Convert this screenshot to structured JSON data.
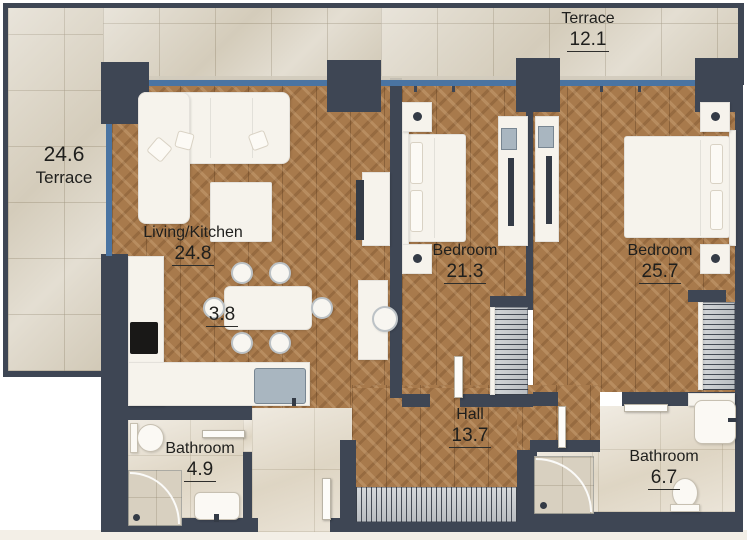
{
  "title": "Apartment floor plan",
  "rooms": [
    {
      "id": "terrace-left",
      "name": "Terrace",
      "area": "24.6"
    },
    {
      "id": "terrace-top",
      "name": "Terrace",
      "area": "12.1"
    },
    {
      "id": "living-kitchen",
      "name": "Living/Kitchen",
      "area": "24.8"
    },
    {
      "id": "kitchen-zone",
      "name": "",
      "area": "3.8"
    },
    {
      "id": "bedroom-1",
      "name": "Bedroom",
      "area": "21.3"
    },
    {
      "id": "bedroom-2",
      "name": "Bedroom",
      "area": "25.7"
    },
    {
      "id": "hall",
      "name": "Hall",
      "area": "13.7"
    },
    {
      "id": "bathroom-1",
      "name": "Bathroom",
      "area": "4.9"
    },
    {
      "id": "bathroom-2",
      "name": "Bathroom",
      "area": "6.7"
    }
  ],
  "colors": {
    "wall": "#3e4654",
    "window": "#4a74a2",
    "wood_floor": "#a87a4c",
    "tile_floor": "#ddd6c7",
    "furniture": "#f6f3ec"
  }
}
